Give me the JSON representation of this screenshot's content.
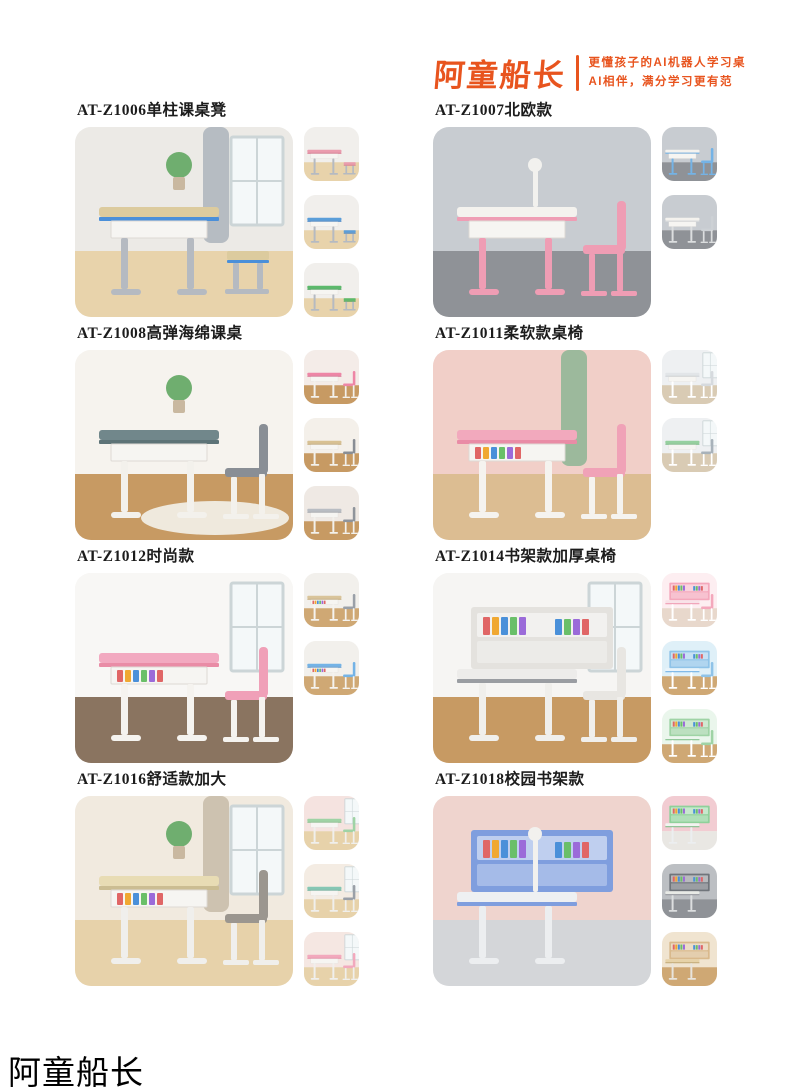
{
  "header": {
    "logo_text": "阿童船长",
    "tagline_line1": "更懂孩子的AI机器人学习桌",
    "tagline_line2": "AI相伴，满分学习更有范",
    "brand_color": "#e8541e"
  },
  "footer": {
    "brand_text": "阿童船长"
  },
  "products": [
    {
      "title": "AT-Z1006单柱课桌凳",
      "main": {
        "kind": "stool",
        "desc": "blue-trim school desk with stool, curtain and window",
        "wall": "#eceae6",
        "floor": "#e8d3ab",
        "curtain": "#b6bcc2",
        "window": true,
        "plant": true,
        "top": "#dccb9e",
        "edge": "#4a8fd9",
        "frame": "#b5bac1"
      },
      "thumbs": [
        {
          "variant": "pink",
          "wall": "#f1efec",
          "floor": "#e8d3ab",
          "top": "#ea9cae",
          "edge": "#d9758d",
          "frame": "#b5bac1"
        },
        {
          "variant": "blue",
          "wall": "#f1efec",
          "floor": "#e8d3ab",
          "top": "#5b9ed9",
          "edge": "#3d7fc4",
          "frame": "#b5bac1"
        },
        {
          "variant": "green",
          "wall": "#f1efec",
          "floor": "#e8d3ab",
          "top": "#5cb96b",
          "edge": "#3f9e52",
          "frame": "#b5bac1"
        }
      ]
    },
    {
      "title": "AT-Z1007北欧款",
      "main": {
        "kind": "chair",
        "desc": "pink desk and chair in grey room with lamp",
        "wall": "#c8ccd1",
        "floor": "#8f9297",
        "lamp": true,
        "top": "#f4f2ee",
        "edge": "#ef9db4",
        "frame": "#ef9db4",
        "seat": "#ef9db4"
      },
      "thumbs": [
        {
          "variant": "blue",
          "wall": "#c8ccd1",
          "floor": "#8f9297",
          "top": "#f4f2ee",
          "edge": "#74b3e6",
          "frame": "#74b3e6",
          "seat": "#74b3e6"
        },
        {
          "variant": "grey",
          "wall": "#c8ccd1",
          "floor": "#8f9297",
          "top": "#f4f2ee",
          "edge": "#d9dbdd",
          "frame": "#dcdedf",
          "seat": "#cdd1d5"
        }
      ]
    },
    {
      "title": "AT-Z1008高弹海绵课桌",
      "main": {
        "kind": "chair",
        "desc": "grey-green desk with padded grey chair on round rug",
        "wall": "#f6f3ee",
        "floor": "#c79a63",
        "rug": "#efe9dd",
        "plant": true,
        "top": "#71878b",
        "edge": "#5d7377",
        "frame": "#f3f1ec",
        "seat": "#898e95"
      },
      "thumbs": [
        {
          "variant": "pink",
          "wall": "#f4ece8",
          "floor": "#c79a63",
          "top": "#ee86a6",
          "edge": "#d96f92",
          "frame": "#f3f1ec",
          "seat": "#ee86a6"
        },
        {
          "variant": "beige",
          "wall": "#f4f0ea",
          "floor": "#c79a63",
          "top": "#d8c193",
          "edge": "#c4ab79",
          "frame": "#f3f1ec",
          "seat": "#898e95"
        },
        {
          "variant": "grey",
          "wall": "#efe9e4",
          "floor": "#c79a63",
          "top": "#b9bdc3",
          "edge": "#a3a8af",
          "frame": "#f3f1ec",
          "seat": "#8f949b"
        }
      ]
    },
    {
      "title": "AT-Z1011柔软款桌椅",
      "main": {
        "kind": "chair",
        "desc": "pink desk and chair, pink wall with green curtain",
        "wall": "#f1cfc8",
        "floor": "#dcbd92",
        "curtain": "#9cb99c",
        "books": true,
        "top": "#f2a9bd",
        "edge": "#e98ca6",
        "frame": "#f5f3ef",
        "seat": "#f0a2b7"
      },
      "thumbs": [
        {
          "variant": "grey",
          "wall": "#eef0f2",
          "floor": "#d9cbb4",
          "window": true,
          "top": "#e2e5e8",
          "edge": "#cfd3d7",
          "frame": "#ffffff",
          "seat": "#d6dade"
        },
        {
          "variant": "green",
          "wall": "#eef0f2",
          "floor": "#d9cbb4",
          "window": true,
          "top": "#96d09f",
          "edge": "#79bb84",
          "frame": "#ffffff",
          "seat": "#a8b2ba"
        }
      ]
    },
    {
      "title": "AT-Z1012时尚款",
      "main": {
        "kind": "chair",
        "desc": "pink desk with books under top, pink chair, white room",
        "wall": "#f8f7f5",
        "floor": "#8a7460",
        "window": true,
        "books": true,
        "top": "#f2a9c0",
        "edge": "#e98ca6",
        "frame": "#f5f3ef",
        "seat": "#f0a0b8"
      },
      "thumbs": [
        {
          "variant": "wood",
          "wall": "#f2f0ec",
          "floor": "#cfa874",
          "books": true,
          "top": "#d9c49a",
          "edge": "#c4ab79",
          "frame": "#f5f3ef",
          "seat": "#9aa0a8"
        },
        {
          "variant": "blue",
          "wall": "#f2f0ec",
          "floor": "#cfa874",
          "books": true,
          "top": "#74b3e6",
          "edge": "#5a97cf",
          "frame": "#f5f3ef",
          "seat": "#74b3e6"
        }
      ]
    },
    {
      "title": "AT-Z1014书架款加厚桌椅",
      "main": {
        "kind": "hutch",
        "desc": "white-grey desk with bookshelf hutch, chair and backpack",
        "wall": "#f6f5f3",
        "floor": "#c79a63",
        "window": true,
        "hutch": "#e4e2de",
        "top": "#edecea",
        "edge": "#9a9da2",
        "frame": "#f0efec",
        "seat": "#e8e6e2"
      },
      "thumbs": [
        {
          "variant": "pink",
          "wall": "#fdeef1",
          "floor": "#e8d8cc",
          "hutch": "#f4a8bc",
          "top": "#f8e2e8",
          "edge": "#ef9db4",
          "frame": "#ffffff",
          "seat": "#f4a8bc"
        },
        {
          "variant": "blue",
          "wall": "#dff0f8",
          "floor": "#cfa874",
          "hutch": "#8fc3e8",
          "top": "#eaf4fa",
          "edge": "#74b3e6",
          "frame": "#ffffff",
          "seat": "#8fc3e8"
        },
        {
          "variant": "green",
          "wall": "#eaf6ec",
          "floor": "#cfa874",
          "hutch": "#9fd3a5",
          "top": "#ecf6ee",
          "edge": "#85c28e",
          "frame": "#ffffff",
          "seat": "#9fd3a5"
        }
      ]
    },
    {
      "title": "AT-Z1016舒适款加大",
      "main": {
        "kind": "chair",
        "desc": "beige desk with grey chair, curtain, window and cactus",
        "wall": "#f1eadf",
        "floor": "#e7d2aa",
        "curtain": "#cdc2b0",
        "window": true,
        "books": true,
        "plant": true,
        "top": "#e8dcb4",
        "edge": "#cbbd92",
        "frame": "#f0efec",
        "seat": "#9b968f"
      },
      "thumbs": [
        {
          "variant": "green",
          "wall": "#f5e3e0",
          "floor": "#e7d2aa",
          "window": true,
          "top": "#9fd3a5",
          "edge": "#85c28e",
          "frame": "#f0efec",
          "seat": "#9fd3a5"
        },
        {
          "variant": "teal",
          "wall": "#f4ece3",
          "floor": "#e7d2aa",
          "window": true,
          "top": "#85c7b4",
          "edge": "#6bb19e",
          "frame": "#f0efec",
          "seat": "#9aa0a8"
        },
        {
          "variant": "pink",
          "wall": "#f5e7e2",
          "floor": "#e7d2aa",
          "window": true,
          "top": "#f2a9bd",
          "edge": "#e98ca6",
          "frame": "#f0efec",
          "seat": "#f2a9bd"
        }
      ]
    },
    {
      "title": "AT-Z1018校园书架款",
      "main": {
        "kind": "hutch",
        "desc": "blue bookshelf desk with lamp, books and globe on pink wall",
        "wall": "#efd4ce",
        "floor": "#d4d6d9",
        "lamp": true,
        "hutch": "#7f9ede",
        "top": "#eef0f2",
        "edge": "#7f9ede",
        "frame": "#eceef0"
      },
      "thumbs": [
        {
          "variant": "green",
          "wall": "#f2ccd2",
          "floor": "#e9e7e3",
          "hutch": "#8fd19a",
          "top": "#f2f4f0",
          "edge": "#85c28e",
          "frame": "#eceef0"
        },
        {
          "variant": "grey",
          "wall": "#bcbfc3",
          "floor": "#8f9297",
          "hutch": "#70757b",
          "top": "#e8eae6",
          "edge": "#9a9da2",
          "frame": "#dcdedf"
        },
        {
          "variant": "wood",
          "wall": "#f0e4d0",
          "floor": "#cfa874",
          "hutch": "#d9b98c",
          "top": "#e6d2a8",
          "edge": "#c4ab79",
          "frame": "#e8e4dc"
        }
      ]
    }
  ]
}
